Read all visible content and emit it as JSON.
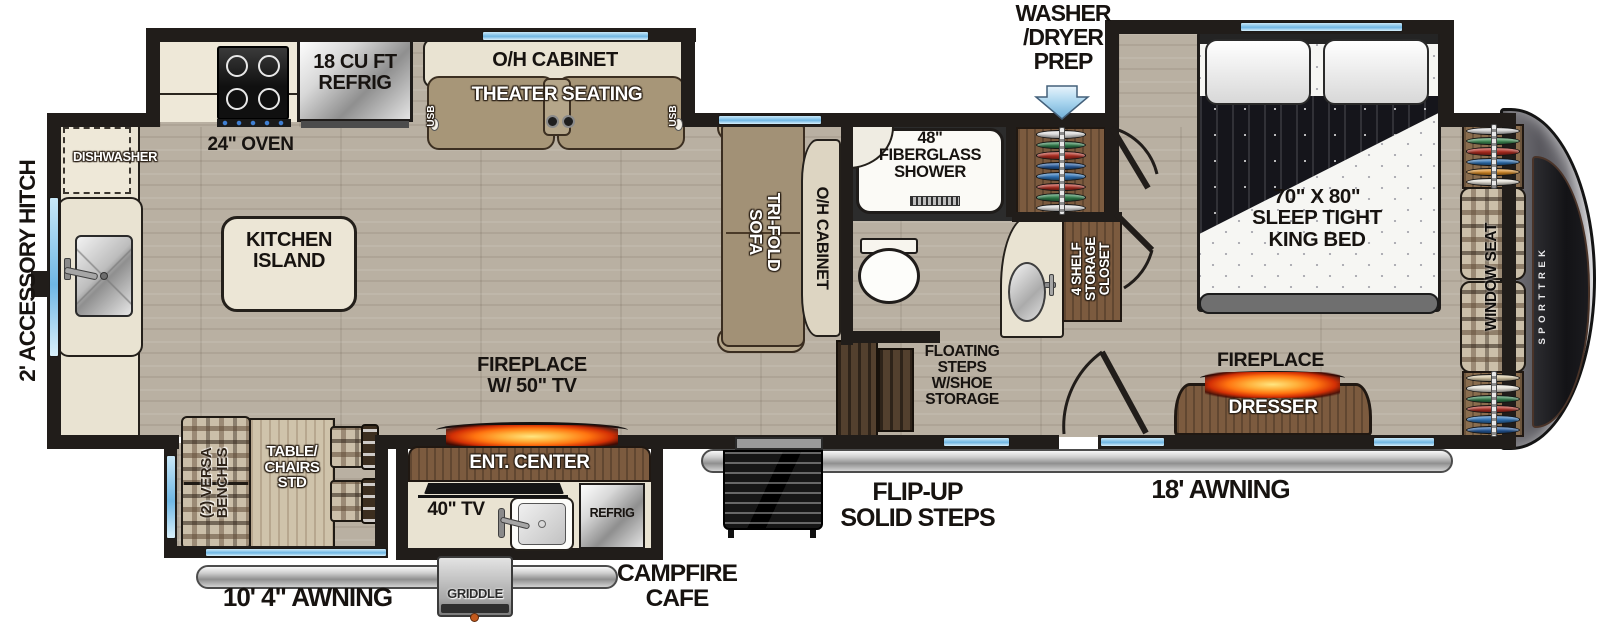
{
  "labels": {
    "hitch": "2' ACCESSORY HITCH",
    "dishwasher": "DISHWASHER",
    "oven": "24\" OVEN",
    "refrig": "18 CU FT\nREFRIG",
    "oh_cabinet": "O/H CABINET",
    "theater": "THEATER SEATING",
    "usb": "USB",
    "island": "KITCHEN\nISLAND",
    "sofa": "TRI-FOLD\nSOFA",
    "sofa_cabinet": "O/H CABINET",
    "shower": "48\"\nFIBERGLASS\nSHOWER",
    "wd_prep": "WASHER\n/DRYER\nPREP",
    "shelf_closet": "4 SHELF\nSTORAGE\nCLOSET",
    "floating_steps": "FLOATING\nSTEPS\nW/SHOE\nSTORAGE",
    "bed": "70\" X 80\"\nSLEEP TIGHT\nKING BED",
    "window_seat": "WINDOW SEAT",
    "brand": "SPORTTREK",
    "fireplace_bed": "FIREPLACE",
    "dresser": "DRESSER",
    "fireplace_tv": "FIREPLACE\nW/ 50\" TV",
    "ent_center": "ENT. CENTER",
    "tv40": "40\" TV",
    "refrig_small": "REFRIG",
    "benches": "(2) VERSA\nBENCHES",
    "table": "TABLE/\nCHAIRS\nSTD",
    "flip_steps": "FLIP-UP\nSOLID STEPS",
    "awning_main": "18' AWNING",
    "awning_rear": "10' 4\" AWNING",
    "griddle": "GRIDDLE",
    "campfire": "CAMPFIRE\nCAFE"
  },
  "hangers": {
    "wd_closet": [
      "#dcdcdc",
      "#2e7d4a",
      "#b02c20",
      "#245a9e",
      "#2e72b5",
      "#b02c20",
      "#2e7d4a",
      "#dcdcdc"
    ],
    "wardrobe_top": [
      "#d8d8d8",
      "#3f8f55",
      "#b02c20",
      "#2e72b5",
      "#d98a23",
      "#e8e4da"
    ],
    "wardrobe_bottom": [
      "#d9c9a4",
      "#e8e4da",
      "#2e7d4a",
      "#b02c20",
      "#2e72b5",
      "#245a9e"
    ]
  },
  "colors": {
    "wall": "#211d1a",
    "floor": "#b9b0a2",
    "window": "#6fb7e4",
    "counter": "#e9e3d2",
    "cabinet_wood": "#7c5b3f",
    "sofa_tan": "#a79678",
    "fire_glow": "#ff7410",
    "front_cap": "#636267",
    "arrow_blue": "#a8d4ee"
  }
}
